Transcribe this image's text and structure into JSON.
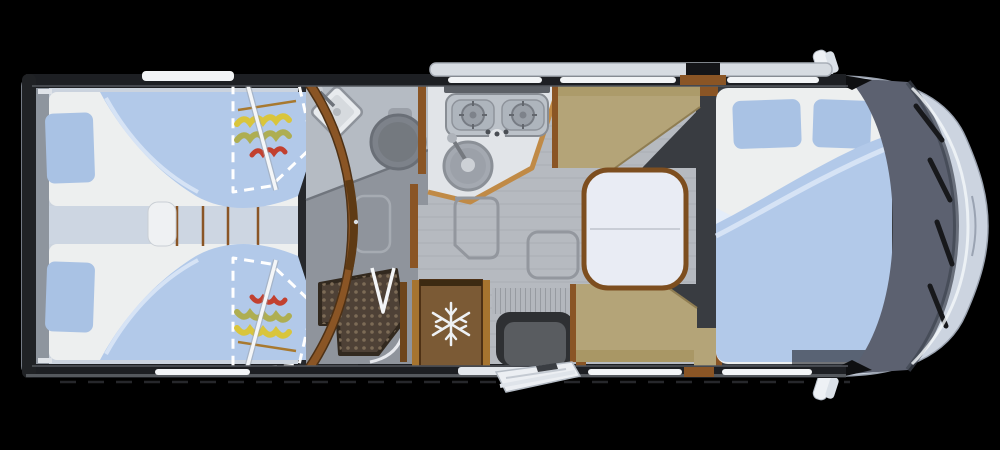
{
  "scene": {
    "background": "#000000"
  },
  "icons": {
    "fridge": "snowflake-icon"
  },
  "colors": {
    "shell": "#ccd4e0",
    "noseHighlight": "#f4f7fa",
    "wall": "#1d1f23",
    "wallInner": "#53575d",
    "floor": "#b6bac0",
    "bedroomFloor": "#cbd3de",
    "aisle": "#cdd6e2",
    "mattress": "#edefef",
    "pillow": "#a9c2e4",
    "duvet": "#b2c9e9",
    "duvetHighlight": "#d9e5f6",
    "sheetFold": "#e4edf9",
    "wood": "#8a5525",
    "woodDark": "#6e451c",
    "woodLight": "#c08a46",
    "dashedLine": "#ffffff",
    "pole": "#f4f6f8",
    "floralYellow": "#d9c53c",
    "floralOlive": "#aeae52",
    "floralRed": "#c2402f",
    "floralStick": "#a8792f",
    "bathCounter": "#b5bbc3",
    "bathFloor": "#8f949c",
    "fixture": "#e8ebee",
    "toilet": "#7d828a",
    "showerTray": "#4e4136",
    "showerDot": "#7c6b56",
    "kitchenCounter": "#e1e4e8",
    "hob": "#bcc2c9",
    "burner": "#9aa0a8",
    "sinkSteel": "#a4a9b1",
    "fridgeBody": "#7b5a35",
    "fridgeWood": "#a6742f",
    "snowflake": "#eef1f4",
    "bench": "#b4a478",
    "benchShade": "#a5935f",
    "tableTop": "#e9ecf4",
    "tableEdge": "#7d4e1f",
    "platform": "#393c41",
    "stepWell": "#2e3033",
    "stepInner": "#595c60",
    "blindRibs": "#b3b7bd",
    "doorFlap": "#eceff3",
    "windshield": "#5c6170",
    "windshieldEdge": "#3f4450",
    "wiper": "#17181b",
    "mirror": "#eef1f5",
    "window": "#f2f4f6",
    "awning": "#d6dbe1"
  }
}
